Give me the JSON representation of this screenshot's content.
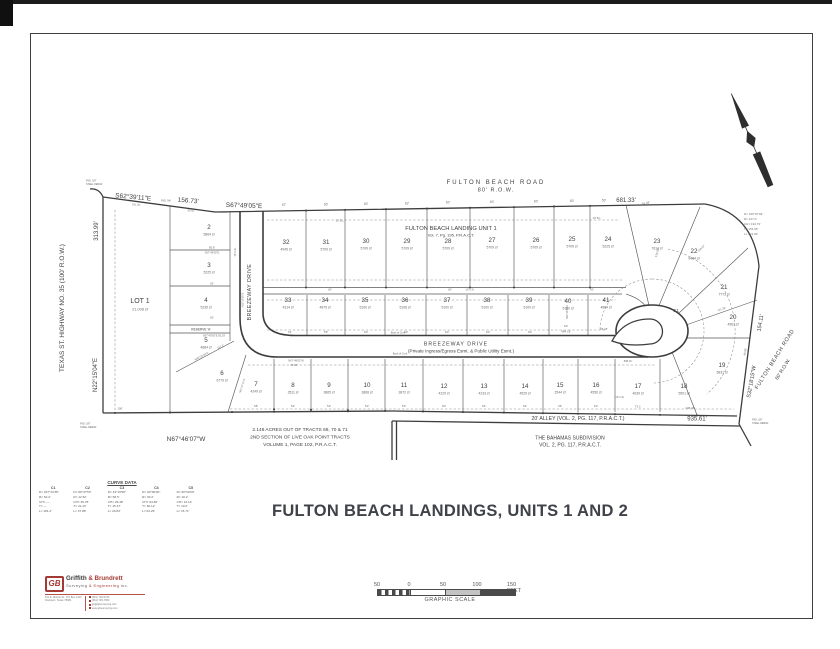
{
  "title": "FULTON BEACH LANDINGS, UNITS 1 AND 2",
  "labels": {
    "fbr_top1": "FULTON BEACH ROAD",
    "fbr_top2": "80' R.O.W.",
    "d681": "681.33'",
    "s62": "S62°39'11\"E",
    "d15673": "156.73'",
    "s67": "S67°49'05\"E",
    "hwy_left": "TEXAS ST. HIGHWAY NO. 35  (100' R.O.W.)",
    "d31399": "313.99'",
    "n22": "N22°15'04\"E",
    "n67": "N67°46'07\"W",
    "lot1": "LOT 1",
    "lot1sf": "21,008 sf",
    "unit1a": "FULTON BEACH LANDING UNIT 1",
    "unit1b": "Vol. 7, Pg. 195, P.R.A.C.T.",
    "bw_v": "BREEZEWAY DRIVE",
    "bw_h": "BREEZEWAY DRIVE",
    "bw_note": "(Private Ingress/Egress Esmt. & Public Utility Esmt.)",
    "alley": "20'  ALLEY     (VOL. 2, PG. 117, P.R.A.C.T.)",
    "d93561": "935.61'",
    "bah1": "THE BAHAMAS SUBDIVISION",
    "bah2": "VOL. 2, PG. 117, P.R.A.C.T.",
    "acre1": "2.148  ACRES  OUT  OF  TRACTS  69,  70  &  71",
    "acre2": "2ND  SECTION  OF  LIVE  OAK  POINT  TRACTS",
    "acre3": "VOLUME  1,  PAGE  102,  P.R.A.C.T.",
    "d15411": "154.11'",
    "s32": "S32°18'15\"W",
    "fbr_r1": "FULTON BEACH ROAD",
    "fbr_r2": "60' R.O.W.",
    "c1": "C1",
    "reserve": "RESERVE 'A'"
  },
  "lots": [
    {
      "n": "2",
      "sf": "5864 sf",
      "x": 209,
      "y": 229
    },
    {
      "n": "3",
      "sf": "5225 sf",
      "x": 209,
      "y": 267
    },
    {
      "n": "4",
      "sf": "5235 sf",
      "x": 206,
      "y": 302
    },
    {
      "n": "5",
      "sf": "4884 sf",
      "x": 206,
      "y": 342
    },
    {
      "n": "6",
      "sf": "6779 sf",
      "x": 222,
      "y": 375
    },
    {
      "n": "7",
      "sf": "4249 sf",
      "x": 256,
      "y": 386
    },
    {
      "n": "8",
      "sf": "3511 sf",
      "x": 293,
      "y": 387
    },
    {
      "n": "9",
      "sf": "3865 sf",
      "x": 329,
      "y": 387
    },
    {
      "n": "10",
      "sf": "3868 sf",
      "x": 367,
      "y": 387
    },
    {
      "n": "11",
      "sf": "3872 sf",
      "x": 404,
      "y": 387
    },
    {
      "n": "12",
      "sf": "4229 sf",
      "x": 444,
      "y": 388
    },
    {
      "n": "13",
      "sf": "4233 sf",
      "x": 484,
      "y": 388
    },
    {
      "n": "14",
      "sf": "4529 sf",
      "x": 525,
      "y": 388
    },
    {
      "n": "15",
      "sf": "2544 sf",
      "x": 560,
      "y": 387
    },
    {
      "n": "16",
      "sf": "4556 sf",
      "x": 596,
      "y": 387
    },
    {
      "n": "17",
      "sf": "4639 sf",
      "x": 638,
      "y": 388
    },
    {
      "n": "18",
      "sf": "5501 sf",
      "x": 684,
      "y": 388
    },
    {
      "n": "19",
      "sf": "5831 sf",
      "x": 722,
      "y": 367
    },
    {
      "n": "20",
      "sf": "4963 sf",
      "x": 733,
      "y": 319
    },
    {
      "n": "21",
      "sf": "7773 sf",
      "x": 724,
      "y": 289
    },
    {
      "n": "22",
      "sf": "8484 sf",
      "x": 694,
      "y": 253
    },
    {
      "n": "23",
      "sf": "7614 sf",
      "x": 657,
      "y": 243
    },
    {
      "n": "24",
      "sf": "5225 sf",
      "x": 608,
      "y": 241
    },
    {
      "n": "25",
      "sf": "5709 sf",
      "x": 572,
      "y": 241
    },
    {
      "n": "26",
      "sf": "5709 sf",
      "x": 536,
      "y": 242
    },
    {
      "n": "27",
      "sf": "5709 sf",
      "x": 492,
      "y": 242
    },
    {
      "n": "28",
      "sf": "5709 sf",
      "x": 448,
      "y": 243
    },
    {
      "n": "29",
      "sf": "5709 sf",
      "x": 407,
      "y": 243
    },
    {
      "n": "30",
      "sf": "5709 sf",
      "x": 366,
      "y": 243
    },
    {
      "n": "31",
      "sf": "5709 sf",
      "x": 326,
      "y": 244
    },
    {
      "n": "32",
      "sf": "4945 sf",
      "x": 286,
      "y": 244
    },
    {
      "n": "33",
      "sf": "4314 sf",
      "x": 288,
      "y": 302
    },
    {
      "n": "34",
      "sf": "4875 sf",
      "x": 325,
      "y": 302
    },
    {
      "n": "35",
      "sf": "5100 sf",
      "x": 365,
      "y": 302
    },
    {
      "n": "36",
      "sf": "5108 sf",
      "x": 405,
      "y": 302
    },
    {
      "n": "37",
      "sf": "5100 sf",
      "x": 447,
      "y": 302
    },
    {
      "n": "38",
      "sf": "5100 sf",
      "x": 487,
      "y": 302
    },
    {
      "n": "39",
      "sf": "5100 sf",
      "x": 529,
      "y": 302
    },
    {
      "n": "40",
      "sf": "5190 sf",
      "x": 568,
      "y": 303
    },
    {
      "n": "41",
      "sf": "4884 sf",
      "x": 606,
      "y": 302
    }
  ],
  "small_dims": [
    [
      "57'",
      284,
      206,
      0,
      3.2
    ],
    [
      "60'",
      326,
      205.5,
      0,
      3.2
    ],
    [
      "60'",
      366,
      205,
      0,
      3.2
    ],
    [
      "62'",
      407,
      204.5,
      0,
      3.2
    ],
    [
      "60'",
      448,
      203.5,
      0,
      3.2
    ],
    [
      "60'",
      492,
      203,
      0,
      3.2
    ],
    [
      "60'",
      536,
      202.5,
      0,
      3.2
    ],
    [
      "60'",
      572,
      202,
      0,
      3.2
    ],
    [
      "50'",
      604,
      201.5,
      0,
      3.2
    ],
    [
      "55.48'",
      646,
      204,
      -12,
      3
    ],
    [
      "100.28'",
      136,
      205.5,
      4,
      2.6
    ],
    [
      "50.52'",
      191,
      211.5,
      4,
      2.6
    ],
    [
      "50.69'",
      224,
      213,
      2,
      2.6
    ],
    [
      "FND. 5/8\"",
      86,
      181.5,
      0,
      2.4,
      "l"
    ],
    [
      "STEEL REBAR",
      86,
      184.8,
      0,
      2.4,
      "l"
    ],
    [
      "FND. 5/8\"",
      752,
      420.5,
      0,
      2.4,
      "l"
    ],
    [
      "STEEL REBAR",
      752,
      423.8,
      0,
      2.4,
      "l"
    ],
    [
      "FND. 5/8\"",
      80,
      424.5,
      0,
      2.4,
      "l"
    ],
    [
      "STEEL REBAR",
      80,
      427.8,
      0,
      2.4,
      "l"
    ],
    [
      "FND. MK",
      166,
      201.5,
      0,
      2.4
    ],
    [
      "D= 100°07'03\"",
      744,
      215,
      0,
      3,
      "l"
    ],
    [
      "R= 127.0'",
      744,
      220,
      0,
      3,
      "l"
    ],
    [
      "CH= 194.73'",
      744,
      225,
      0,
      3,
      "l"
    ],
    [
      "T= 151.65'",
      744,
      230,
      0,
      3,
      "l"
    ],
    [
      "L= 221.92'",
      744,
      235,
      0,
      3,
      "l"
    ],
    [
      "10' B.L.",
      597,
      219,
      0,
      2.6
    ],
    [
      "10' B.L.",
      340,
      221.5,
      0,
      2.6
    ],
    [
      "15' U.E.",
      236,
      252,
      -90,
      2.6
    ],
    [
      "10' U.E.",
      470,
      290.5,
      0,
      2.6
    ],
    [
      "10' U.E.",
      620,
      398,
      0,
      2.6
    ],
    [
      "85.8'",
      212,
      248.5,
      0,
      2.8
    ],
    [
      "S67°49'05\"E",
      212,
      253.5,
      0,
      2.6
    ],
    [
      "65'",
      212,
      284.5,
      0,
      2.8
    ],
    [
      "60'",
      212,
      318.5,
      0,
      2.8
    ],
    [
      "S67°49'05\"E  95.29'",
      214,
      336.5,
      0,
      2.6
    ],
    [
      "N48°20'29\"E",
      202,
      357,
      -28,
      2.7
    ],
    [
      "117.2'",
      221,
      347.5,
      -28,
      2.7
    ],
    [
      "N01°37'31\"E",
      243,
      386,
      -72,
      2.6
    ],
    [
      "N22°10'55\"E",
      243.5,
      300,
      -90,
      2.6
    ],
    [
      "N22°10'58\"E",
      568,
      312,
      -90,
      2.5
    ],
    [
      "61'",
      290,
      333,
      0,
      3
    ],
    [
      "55'",
      326,
      333,
      0,
      3
    ],
    [
      "60'",
      366,
      333,
      0,
      3
    ],
    [
      "60'",
      406,
      333,
      0,
      3
    ],
    [
      "60'",
      447,
      333,
      0,
      3
    ],
    [
      "60'",
      488,
      333,
      0,
      3
    ],
    [
      "60'",
      530,
      333,
      0,
      3
    ],
    [
      "60'",
      566,
      327,
      0,
      3
    ],
    [
      "25.18'",
      604,
      330,
      0,
      2.8
    ],
    [
      "484.18'",
      566,
      332.5,
      0,
      3
    ],
    [
      "60'",
      330,
      290.5,
      0,
      2.8
    ],
    [
      "60'",
      450,
      290.5,
      0,
      2.8
    ],
    [
      "50'",
      592,
      290.5,
      0,
      2.8
    ],
    [
      "Back of Curb",
      398,
      333.5,
      0,
      2.5
    ],
    [
      "Back of Curb",
      400,
      354.5,
      0,
      2.5
    ],
    [
      "N67°49'02\"W",
      296,
      361.5,
      0,
      2.6
    ],
    [
      "47.84'",
      294,
      366,
      0,
      2.8
    ],
    [
      "58'",
      256,
      407,
      0,
      3
    ],
    [
      "52'",
      293,
      407,
      0,
      3
    ],
    [
      "53'",
      329,
      407,
      0,
      3
    ],
    [
      "53'",
      367,
      407,
      0,
      3
    ],
    [
      "53'",
      404,
      407,
      0,
      3
    ],
    [
      "60'",
      444,
      407,
      0,
      3
    ],
    [
      "64'",
      484,
      407,
      0,
      3
    ],
    [
      "64'",
      525,
      407,
      0,
      3
    ],
    [
      "36'",
      560,
      407,
      0,
      3
    ],
    [
      "63'",
      596,
      407,
      0,
      3
    ],
    [
      "73.1'",
      638,
      407.5,
      0,
      3
    ],
    [
      "108.38'",
      690,
      409,
      0,
      3
    ],
    [
      "100'",
      120,
      409.5,
      0,
      3
    ],
    [
      "134.08'",
      658,
      253,
      -73,
      2.8
    ],
    [
      "103.87'",
      702,
      249,
      -43,
      2.8
    ],
    [
      "111.32'",
      722,
      310,
      -18,
      2.8
    ],
    [
      "49.98'",
      746,
      352,
      -81,
      2.8
    ],
    [
      "598.01'",
      628,
      362,
      0,
      2.6
    ]
  ],
  "curve_table": {
    "title": "CURVE DATA",
    "row_labels": [
      "D=",
      "R=",
      "CH=",
      "T=",
      "L="
    ],
    "curves": [
      {
        "id": "C1",
        "vals": [
          "267°34'38\"",
          "52.2'",
          "—",
          "—",
          "181.2'"
        ]
      },
      {
        "id": "C2",
        "vals": [
          "89°47'53\"",
          "12.52'",
          "35.78'",
          "21.43'",
          "37.88'"
        ]
      },
      {
        "id": "C3",
        "vals": [
          "34°19'58\"",
          "58.5'",
          "29.38'",
          "15.37'",
          "29.83'"
        ]
      },
      {
        "id": "C4",
        "vals": [
          "90°00'00\"",
          "60.2'",
          "64.86'",
          "60.12'",
          "64.26'"
        ]
      },
      {
        "id": "C5",
        "vals": [
          "90°00'00\"",
          "10.2'",
          "14.14'",
          "10.2'",
          "15.71'"
        ]
      }
    ]
  },
  "logo": {
    "mark": "GB",
    "name1": "Griffith ",
    "amp": "& ",
    "name2": "Brundrett",
    "tag1": "Surveying ",
    "tag_amp": "& ",
    "tag2": "Engineering ",
    "tag3": "inc.",
    "addr1": "611 E. Market St., PO Box 2122",
    "addr2": "Rockport, Texas  78381",
    "ph1": "(361) 729-5476",
    "ph2": "(361) 729-7953",
    "email": "gb@gbsurveying.com",
    "web": "www.gbsurveying.com"
  },
  "scale": {
    "ticks": [
      "50",
      "0",
      "50",
      "100",
      "150 FEET"
    ],
    "label": "GRAPHIC SCALE"
  }
}
